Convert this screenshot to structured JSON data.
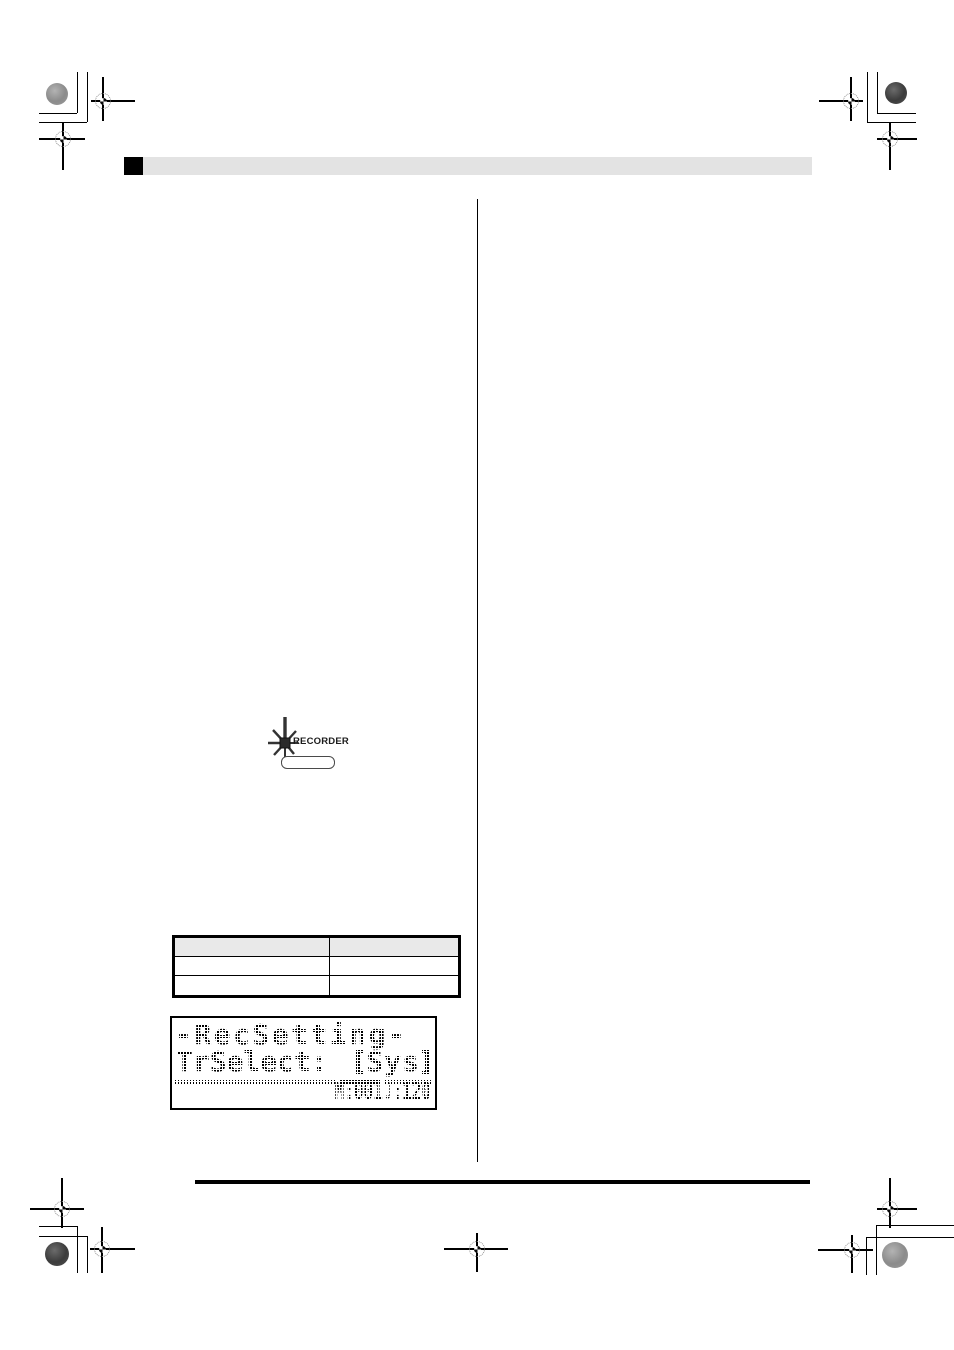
{
  "recorder": {
    "label": "RECORDER"
  },
  "table": {
    "headers": [
      "",
      ""
    ],
    "rows": [
      [
        "",
        ""
      ],
      [
        "",
        ""
      ]
    ],
    "header_fill": "#e9e9e9"
  },
  "lcd": {
    "line1": "-RecSetting-",
    "line2_label": "TrSelect:",
    "line2_value": "Sys",
    "status_measure": "M:001",
    "status_note": "♩",
    "status_tempo": ":120"
  },
  "colors": {
    "header_bar_gray": "#e3e3e3",
    "ink": "#000000"
  }
}
